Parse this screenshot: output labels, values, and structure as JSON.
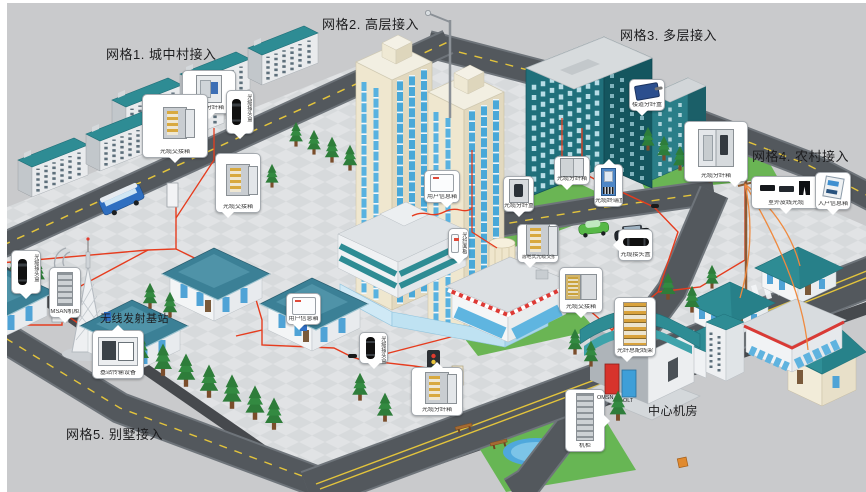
{
  "diagram": {
    "grid1": "网格1. 城中村接入",
    "grid2": "网格2. 高层接入",
    "grid3": "网格3. 多层接入",
    "grid4": "网格4. 农村接入",
    "grid5": "网格5. 别墅接入",
    "central_room": "中心机房",
    "base_station": "无线发射基站",
    "omsn": "OMSN",
    "olt": "OLT"
  },
  "callouts": [
    {
      "id": "grid1-cross-cabinet",
      "label": "光缆交接箱"
    },
    {
      "id": "grid1-fdb",
      "label": "光缆分纤箱"
    },
    {
      "id": "grid1-closure",
      "label": "光缆接头盒"
    },
    {
      "id": "grid1-cross-cabinet-2",
      "label": "光缆交接箱"
    },
    {
      "id": "user-info-box-tower",
      "label": "用户信息箱"
    },
    {
      "id": "fiber-panel",
      "label": "光纤面板"
    },
    {
      "id": "fdb-tower",
      "label": "光缆分纤盒"
    },
    {
      "id": "floor-cross-cabinet",
      "label": "落地式光缆交接箱"
    },
    {
      "id": "fdb-2",
      "label": "光缆分纤箱"
    },
    {
      "id": "splitter-box",
      "label": "光缆终端盒"
    },
    {
      "id": "closure-h",
      "label": "光缆接头盒"
    },
    {
      "id": "cross-cabinet-3",
      "label": "光缆交接箱"
    },
    {
      "id": "corridor-box",
      "label": "楼道分纤盒"
    },
    {
      "id": "fdb-rural",
      "label": "光缆分纤箱"
    },
    {
      "id": "drop-cable",
      "label": "室外皮线光缆"
    },
    {
      "id": "home-info-box",
      "label": "入户信息箱"
    },
    {
      "id": "closure-left",
      "label": "光缆接头盒"
    },
    {
      "id": "msan-cabinet",
      "label": "MSAN机柜"
    },
    {
      "id": "bts-equipment",
      "label": "基站传输设备"
    },
    {
      "id": "user-info-box-villa",
      "label": "用户信息箱"
    },
    {
      "id": "closure-villa",
      "label": "光缆接头盒"
    },
    {
      "id": "fdb-villa",
      "label": "光缆分纤箱"
    },
    {
      "id": "odf",
      "label": "光纤总配线架"
    },
    {
      "id": "rack",
      "label": "机柜"
    }
  ],
  "colors": {
    "background": "#c9cacc",
    "plaza": "#e1e3e5",
    "road": "#53585d",
    "lane_marking": "#e3c43c",
    "roof_teal": "#2e8c94",
    "tower_cream": "#efe7cf",
    "window_blue": "#57b2e0",
    "fiber_line": "#e63c1e",
    "rural_drop": "#ef8a3f",
    "grass": "#6ab554",
    "omsn_cabinet": "#d7332c",
    "olt_cabinet": "#3f9fd8"
  }
}
